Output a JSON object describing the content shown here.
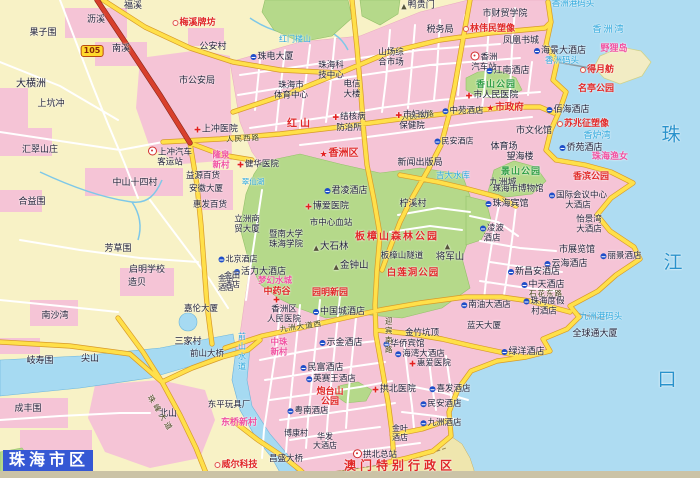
{
  "title": "珠海市区",
  "colors": {
    "land": "#f8f2c6",
    "sea": "#aedcf2",
    "urban": "#f5c4d6",
    "park": "#b5d98a",
    "river": "#a6daf2",
    "roady": "#ffe04a",
    "roadr": "#d8402c",
    "poi": "#e02828",
    "watertext": "#2aa6dc"
  },
  "labels": [
    {
      "t": "福溪",
      "x": 133,
      "y": 6
    },
    {
      "t": "沥溪",
      "x": 96,
      "y": 20
    },
    {
      "t": "梅溪牌坊",
      "x": 194,
      "y": 23,
      "c": "r",
      "ic": "d"
    },
    {
      "t": "果子围",
      "x": 43,
      "y": 33
    },
    {
      "t": "南溪",
      "x": 121,
      "y": 49
    },
    {
      "t": "公安村",
      "x": 213,
      "y": 47
    },
    {
      "t": "105",
      "x": 92,
      "y": 51,
      "c": "badge",
      "n": "route-105-badge"
    },
    {
      "t": "大横洲",
      "x": 31,
      "y": 84,
      "s": 10
    },
    {
      "t": "上坑冲",
      "x": 51,
      "y": 104
    },
    {
      "t": "汇翠山庄",
      "x": 40,
      "y": 150
    },
    {
      "t": "市公安局",
      "x": 197,
      "y": 81
    },
    {
      "t": "上冲医院",
      "x": 216,
      "y": 130,
      "ic": "x"
    },
    {
      "t": "上冲汽车\n客运站",
      "x": 170,
      "y": 157,
      "s": 8.5,
      "ic": "b"
    },
    {
      "t": "隆泉\n新村",
      "x": 221,
      "y": 161,
      "c": "m",
      "s": 8.5
    },
    {
      "t": "益源百货",
      "x": 203,
      "y": 177,
      "s": 8.5
    },
    {
      "t": "安徽大厦",
      "x": 206,
      "y": 190,
      "s": 8.5
    },
    {
      "t": "惠发百货",
      "x": 210,
      "y": 206,
      "s": 8.5
    },
    {
      "t": "中山十四村",
      "x": 135,
      "y": 183
    },
    {
      "t": "合益围",
      "x": 32,
      "y": 202
    },
    {
      "t": "芳草围",
      "x": 118,
      "y": 249
    },
    {
      "t": "启明学校",
      "x": 147,
      "y": 270
    },
    {
      "t": "造贝",
      "x": 137,
      "y": 283
    },
    {
      "t": "南沙湾",
      "x": 55,
      "y": 316
    },
    {
      "t": "岐寿围",
      "x": 40,
      "y": 361
    },
    {
      "t": "尖山",
      "x": 90,
      "y": 359
    },
    {
      "t": "成丰围",
      "x": 28,
      "y": 409
    },
    {
      "t": "北山",
      "x": 168,
      "y": 414
    },
    {
      "t": "三家村",
      "x": 188,
      "y": 342
    },
    {
      "t": "前山大桥",
      "x": 207,
      "y": 355,
      "s": 8.5
    },
    {
      "t": "东平玩具厂",
      "x": 229,
      "y": 406,
      "s": 8.5
    },
    {
      "t": "东桥新村",
      "x": 239,
      "y": 423,
      "c": "m"
    },
    {
      "t": "威尔科技",
      "x": 236,
      "y": 465,
      "c": "r",
      "ic": "d"
    },
    {
      "t": "昌盛大桥",
      "x": 286,
      "y": 460,
      "s": 8.5
    },
    {
      "t": "博康村",
      "x": 296,
      "y": 434,
      "s": 8
    },
    {
      "t": "珠峰大道",
      "x": 160,
      "y": 414,
      "c": "rd",
      "rot": 58,
      "ls": 3
    },
    {
      "t": "鸭贵门",
      "x": 418,
      "y": 6,
      "ic": "p"
    },
    {
      "t": "市财贸学院",
      "x": 505,
      "y": 14
    },
    {
      "t": "税务局",
      "x": 440,
      "y": 30
    },
    {
      "t": "林伟民塑像",
      "x": 489,
      "y": 29,
      "c": "r",
      "ic": "d"
    },
    {
      "t": "凤凰书城",
      "x": 521,
      "y": 41
    },
    {
      "t": "海景大酒店",
      "x": 560,
      "y": 51,
      "ic": "h"
    },
    {
      "t": "香洲码头",
      "x": 562,
      "y": 62,
      "c": "w",
      "s": 8.5
    },
    {
      "t": "香洲\n汽车站",
      "x": 484,
      "y": 62,
      "s": 8.5,
      "ic": "b"
    },
    {
      "t": "江南酒店",
      "x": 508,
      "y": 71,
      "ic": "h"
    },
    {
      "t": "香山公园",
      "x": 496,
      "y": 85,
      "c": "g"
    },
    {
      "t": "市人民医院",
      "x": 492,
      "y": 96,
      "ic": "x"
    },
    {
      "t": "市政府",
      "x": 505,
      "y": 109,
      "c": "r",
      "s": 9.5,
      "ic": "st"
    },
    {
      "t": "佰海酒店",
      "x": 568,
      "y": 110,
      "ic": "h"
    },
    {
      "t": "苏兆征塑像",
      "x": 583,
      "y": 124,
      "c": "r",
      "ic": "d"
    },
    {
      "t": "市文化馆",
      "x": 534,
      "y": 131
    },
    {
      "t": "体育场",
      "x": 504,
      "y": 147
    },
    {
      "t": "望海楼",
      "x": 520,
      "y": 157
    },
    {
      "t": "侨苑酒店",
      "x": 581,
      "y": 148,
      "ic": "h"
    },
    {
      "t": "珠海渔女",
      "x": 610,
      "y": 157,
      "c": "m"
    },
    {
      "t": "香炉湾",
      "x": 597,
      "y": 136,
      "c": "w"
    },
    {
      "t": "名亭公园",
      "x": 596,
      "y": 89,
      "c": "r"
    },
    {
      "t": "得月舫",
      "x": 597,
      "y": 70,
      "c": "r",
      "ic": "d"
    },
    {
      "t": "野狸岛",
      "x": 614,
      "y": 49,
      "c": "m"
    },
    {
      "t": "香洲湾",
      "x": 609,
      "y": 30,
      "c": "w",
      "ls": 2
    },
    {
      "t": "香洲港码头",
      "x": 573,
      "y": 5,
      "c": "w",
      "s": 8.5
    },
    {
      "t": "珠",
      "x": 671,
      "y": 135,
      "c": "W"
    },
    {
      "t": "江",
      "x": 673,
      "y": 263,
      "c": "W"
    },
    {
      "t": "口",
      "x": 667,
      "y": 380,
      "c": "W"
    },
    {
      "t": "珠电大厦",
      "x": 272,
      "y": 57,
      "ic": "h"
    },
    {
      "t": "山场综\n合市场",
      "x": 391,
      "y": 58,
      "s": 8.5
    },
    {
      "t": "红门楼山",
      "x": 295,
      "y": 40,
      "c": "w",
      "s": 8
    },
    {
      "t": "珠海科\n技中心",
      "x": 331,
      "y": 71,
      "s": 8.5
    },
    {
      "t": "珠海市\n体育中心",
      "x": 291,
      "y": 91,
      "s": 8.5
    },
    {
      "t": "电信\n大楼",
      "x": 352,
      "y": 90,
      "s": 8.5
    },
    {
      "t": "红山",
      "x": 300,
      "y": 124,
      "c": "r",
      "s": 10,
      "ls": 3
    },
    {
      "t": "人民西路",
      "x": 243,
      "y": 139,
      "c": "rd",
      "rot": -3
    },
    {
      "t": "人民东路",
      "x": 418,
      "y": 116,
      "c": "rd",
      "rot": -7
    },
    {
      "t": "结核病\n防治所",
      "x": 349,
      "y": 123,
      "s": 8.5,
      "ic": "x"
    },
    {
      "t": "市妇幼\n保健院",
      "x": 412,
      "y": 121,
      "s": 8.5,
      "ic": "x"
    },
    {
      "t": "中苑酒店",
      "x": 463,
      "y": 112,
      "s": 8.5,
      "ic": "h"
    },
    {
      "t": "民安酒店",
      "x": 454,
      "y": 142,
      "s": 8,
      "ic": "h"
    },
    {
      "t": "香洲区",
      "x": 339,
      "y": 154,
      "c": "r",
      "s": 10,
      "ic": "st"
    },
    {
      "t": "新闻出版局",
      "x": 420,
      "y": 163
    },
    {
      "t": "吉大水库",
      "x": 453,
      "y": 177,
      "c": "w",
      "s": 8.5
    },
    {
      "t": "柠溪村",
      "x": 413,
      "y": 204
    },
    {
      "t": "君凌酒店",
      "x": 346,
      "y": 191,
      "ic": "h"
    },
    {
      "t": "博爱医院",
      "x": 327,
      "y": 207,
      "ic": "x"
    },
    {
      "t": "市中心血站",
      "x": 331,
      "y": 224,
      "s": 8.5
    },
    {
      "t": "健华医院",
      "x": 258,
      "y": 166,
      "s": 8.5,
      "ic": "x"
    },
    {
      "t": "翠仙湖",
      "x": 253,
      "y": 182,
      "c": "w",
      "s": 7.5
    },
    {
      "t": "立洲商\n贸大厦",
      "x": 247,
      "y": 225,
      "s": 8.5
    },
    {
      "t": "北京酒店",
      "x": 238,
      "y": 260,
      "s": 8,
      "ic": "h"
    },
    {
      "t": "金怡\n酒店",
      "x": 226,
      "y": 284,
      "s": 8
    },
    {
      "t": "暨南大学\n珠海学院",
      "x": 286,
      "y": 240,
      "s": 8.5
    },
    {
      "t": "大石林",
      "x": 331,
      "y": 248,
      "s": 9.5,
      "ic": "p"
    },
    {
      "t": "金钟山",
      "x": 351,
      "y": 267,
      "s": 9.5,
      "ic": "p"
    },
    {
      "t": "板樟山森林公园",
      "x": 397,
      "y": 237,
      "c": "r",
      "s": 10,
      "ls": 2
    },
    {
      "t": "板樟山隧道",
      "x": 402,
      "y": 257,
      "s": 8.5
    },
    {
      "t": "",
      "x": 448,
      "y": 246,
      "ic": "p"
    },
    {
      "t": "将军山",
      "x": 450,
      "y": 258,
      "s": 9.5
    },
    {
      "t": "白莲洞公园",
      "x": 413,
      "y": 274,
      "c": "r",
      "s": 9.5,
      "ls": 1
    },
    {
      "t": "活力大酒店",
      "x": 260,
      "y": 272,
      "ic": "h"
    },
    {
      "t": "金田\n酒店",
      "x": 232,
      "y": 281,
      "s": 8
    },
    {
      "t": "梦幻水城",
      "x": 275,
      "y": 282,
      "c": "m",
      "s": 8.5
    },
    {
      "t": "中药谷",
      "x": 277,
      "y": 292,
      "c": "r"
    },
    {
      "t": "",
      "x": 277,
      "y": 300,
      "ic": "x"
    },
    {
      "t": "园明新园",
      "x": 330,
      "y": 293,
      "c": "r"
    },
    {
      "t": "嘉伦大厦",
      "x": 201,
      "y": 310,
      "s": 8.5
    },
    {
      "t": "香洲区\n人民医院",
      "x": 284,
      "y": 315,
      "s": 8.5
    },
    {
      "t": "中国城酒店",
      "x": 339,
      "y": 312,
      "ic": "h"
    },
    {
      "t": "九洲大道西",
      "x": 301,
      "y": 327,
      "c": "rd",
      "rot": -8
    },
    {
      "t": "中珠\n新村",
      "x": 279,
      "y": 348,
      "c": "m",
      "s": 8.5
    },
    {
      "t": "示金酒店",
      "x": 341,
      "y": 343,
      "ic": "h"
    },
    {
      "t": "民富酒店",
      "x": 322,
      "y": 368,
      "ic": "h"
    },
    {
      "t": "英赛王酒店",
      "x": 331,
      "y": 380,
      "s": 8.5,
      "ic": "h"
    },
    {
      "t": "炮台山\n公园",
      "x": 330,
      "y": 397,
      "c": "r",
      "s": 9
    },
    {
      "t": "拱北医院",
      "x": 394,
      "y": 390,
      "ic": "x"
    },
    {
      "t": "华侨宾馆",
      "x": 404,
      "y": 345,
      "s": 8.5,
      "ic": "h"
    },
    {
      "t": "海湾大酒店",
      "x": 420,
      "y": 355,
      "s": 8.5,
      "ic": "h"
    },
    {
      "t": "惠爱医院",
      "x": 430,
      "y": 365,
      "s": 8.5,
      "ic": "x"
    },
    {
      "t": "金竹坑顶",
      "x": 422,
      "y": 334,
      "s": 8.5
    },
    {
      "t": "喜发酒店",
      "x": 450,
      "y": 390,
      "s": 8.5,
      "ic": "h"
    },
    {
      "t": "民安酒店",
      "x": 441,
      "y": 405,
      "s": 8.5,
      "ic": "h"
    },
    {
      "t": "九洲酒店",
      "x": 441,
      "y": 424,
      "s": 8.5,
      "ic": "h"
    },
    {
      "t": "粤南酒店",
      "x": 308,
      "y": 412,
      "s": 8.5,
      "ic": "h"
    },
    {
      "t": "金叶\n酒店",
      "x": 400,
      "y": 434,
      "s": 8
    },
    {
      "t": "华发\n大酒店",
      "x": 325,
      "y": 442,
      "s": 8
    },
    {
      "t": "拱北总站",
      "x": 375,
      "y": 455,
      "s": 8.5,
      "ic": "b"
    },
    {
      "t": "澳门特别行政区",
      "x": 400,
      "y": 466,
      "c": "r",
      "s": 12,
      "ls": 4,
      "n": "macau-region-label"
    },
    {
      "t": "迎宾南路",
      "x": 388,
      "y": 336,
      "c": "rd",
      "v": 1,
      "ls": 2
    },
    {
      "t": "前山水道",
      "x": 241,
      "y": 352,
      "c": "w",
      "v": 1,
      "s": 8,
      "ls": 2
    },
    {
      "t": "石花东路",
      "x": 546,
      "y": 294,
      "c": "rd"
    },
    {
      "t": "景山公园",
      "x": 521,
      "y": 172,
      "c": "g"
    },
    {
      "t": "香滨公园",
      "x": 591,
      "y": 177,
      "c": "r"
    },
    {
      "t": "九洲城",
      "x": 503,
      "y": 183
    },
    {
      "t": "珠海市博物馆",
      "x": 518,
      "y": 190,
      "s": 8.5
    },
    {
      "t": "珠海宾馆",
      "x": 507,
      "y": 204,
      "ic": "h"
    },
    {
      "t": "国际会议中心\n大酒店",
      "x": 578,
      "y": 201,
      "s": 8.5,
      "ic": "h"
    },
    {
      "t": "怡景湾\n大酒店",
      "x": 589,
      "y": 225,
      "s": 8.5
    },
    {
      "t": "凌波\n酒店",
      "x": 492,
      "y": 234,
      "s": 8.5,
      "ic": "h"
    },
    {
      "t": "市展览馆",
      "x": 577,
      "y": 250
    },
    {
      "t": "丽景酒店",
      "x": 621,
      "y": 257,
      "s": 8.5,
      "ic": "h"
    },
    {
      "t": "云海酒店",
      "x": 566,
      "y": 264,
      "ic": "h"
    },
    {
      "t": "新昌安酒店",
      "x": 534,
      "y": 272,
      "ic": "h"
    },
    {
      "t": "中天酒店",
      "x": 543,
      "y": 285,
      "ic": "h"
    },
    {
      "t": "珠海度假\n村酒店",
      "x": 544,
      "y": 307,
      "s": 8.5,
      "ic": "h"
    },
    {
      "t": "南油大酒店",
      "x": 486,
      "y": 306,
      "s": 8.5,
      "ic": "h"
    },
    {
      "t": "九洲港码头",
      "x": 601,
      "y": 318,
      "c": "w",
      "s": 8.5
    },
    {
      "t": "全球通大厦",
      "x": 595,
      "y": 334
    },
    {
      "t": "绿洋酒店",
      "x": 523,
      "y": 352,
      "ic": "h"
    },
    {
      "t": "蓝天大厦",
      "x": 484,
      "y": 327,
      "s": 8.5
    }
  ]
}
